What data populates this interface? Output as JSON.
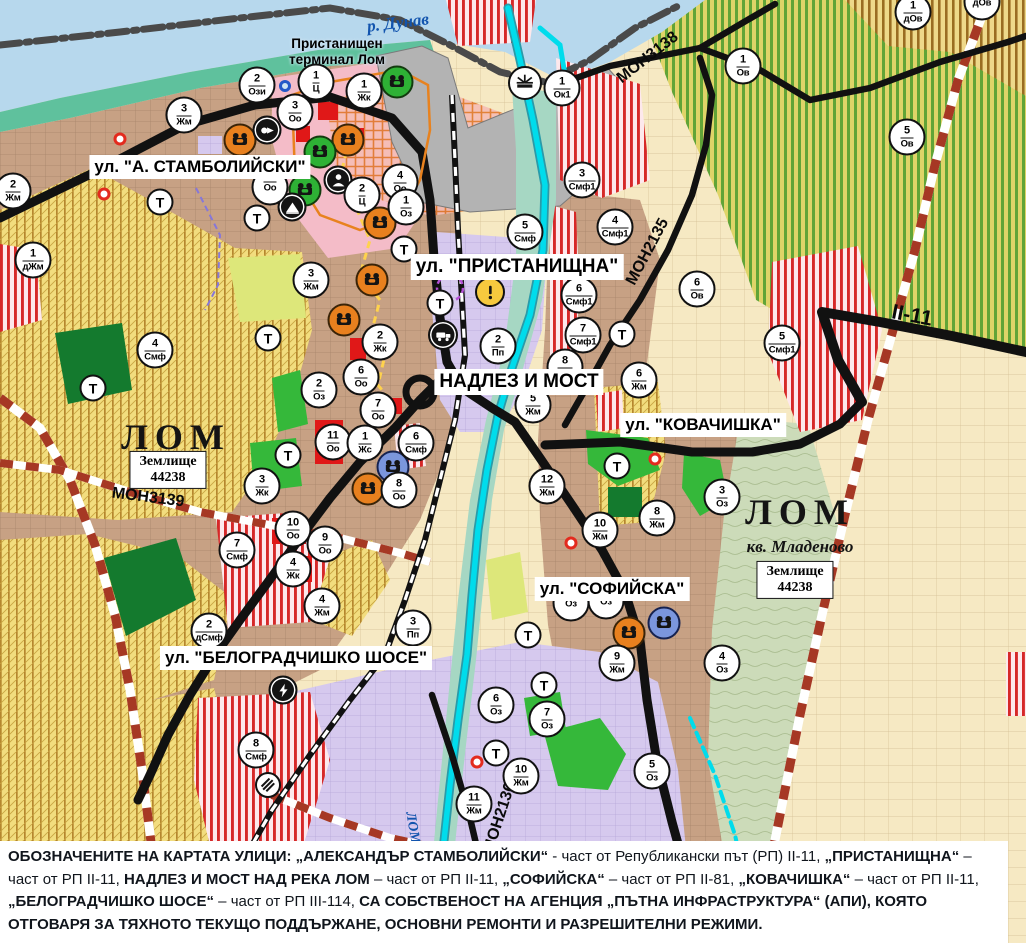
{
  "map": {
    "water_label": "р. Дунав",
    "river_label_vertical": "ЛОМ",
    "port_label": "Пристанищен\nтерминал Лом",
    "city_labels": [
      {
        "text": "ЛОМ",
        "x": 176,
        "y": 437
      },
      {
        "text": "ЛОМ",
        "x": 800,
        "y": 512
      }
    ],
    "district_label": {
      "text": "кв. Младеново",
      "x": 800,
      "y": 547
    },
    "land_plots": [
      {
        "text": "Землище\n44238",
        "x": 168,
        "y": 470
      },
      {
        "text": "Землище\n44238",
        "x": 795,
        "y": 580
      }
    ],
    "street_labels": [
      {
        "text": "ул. \"А. СТАМБОЛИЙСКИ\"",
        "x": 200,
        "y": 167,
        "size": "normal"
      },
      {
        "text": "ул. \"ПРИСТАНИЩНА\"",
        "x": 517,
        "y": 267,
        "size": "big"
      },
      {
        "text": "НАДЛЕЗ И МОСТ",
        "x": 519,
        "y": 382,
        "size": "big"
      },
      {
        "text": "ул. \"КОВАЧИШКА\"",
        "x": 703,
        "y": 425,
        "size": "normal"
      },
      {
        "text": "ул. \"СОФИЙСКА\"",
        "x": 612,
        "y": 589,
        "size": "normal"
      },
      {
        "text": "ул. \"БЕЛОГРАДЧИШКО ШОСЕ\"",
        "x": 296,
        "y": 658,
        "size": "normal"
      }
    ],
    "road_labels": [
      {
        "text": "МОН3138",
        "x": 648,
        "y": 58,
        "rotate": -38,
        "size": "normal"
      },
      {
        "text": "МОН2135",
        "x": 648,
        "y": 252,
        "rotate": -62,
        "size": "normal"
      },
      {
        "text": "II-11",
        "x": 912,
        "y": 316,
        "rotate": 11,
        "size": "big"
      },
      {
        "text": "МОН3139",
        "x": 148,
        "y": 498,
        "rotate": 7,
        "size": "normal"
      },
      {
        "text": "МОН2136",
        "x": 500,
        "y": 818,
        "rotate": -72,
        "size": "normal"
      }
    ],
    "zone_markers": [
      {
        "num": "2",
        "code": "Ози",
        "x": 257,
        "y": 85
      },
      {
        "num": "1",
        "code": "Ц",
        "x": 316,
        "y": 82
      },
      {
        "num": "1",
        "code": "Жк",
        "x": 364,
        "y": 91
      },
      {
        "num": "3",
        "code": "Оо",
        "x": 295,
        "y": 112
      },
      {
        "num": "1",
        "code": "Ок1",
        "x": 562,
        "y": 88
      },
      {
        "num": "3",
        "code": "Жм",
        "x": 184,
        "y": 115
      },
      {
        "num": "2",
        "code": "Жм",
        "x": 13,
        "y": 191
      },
      {
        "num": "1",
        "code": "дЖм",
        "x": 33,
        "y": 260
      },
      {
        "num": "4",
        "code": "Оо",
        "x": 400,
        "y": 182
      },
      {
        "num": "2",
        "code": "Ц",
        "x": 362,
        "y": 195
      },
      {
        "num": "1",
        "code": "Оз",
        "x": 406,
        "y": 207
      },
      {
        "num": "",
        "code": "Оо",
        "x": 270,
        "y": 187
      },
      {
        "num": "3",
        "code": "Жм",
        "x": 311,
        "y": 280
      },
      {
        "num": "2",
        "code": "Жк",
        "x": 380,
        "y": 342
      },
      {
        "num": "6",
        "code": "Оо",
        "x": 361,
        "y": 377
      },
      {
        "num": "7",
        "code": "Оо",
        "x": 378,
        "y": 410
      },
      {
        "num": "2",
        "code": "Оз",
        "x": 319,
        "y": 390
      },
      {
        "num": "11",
        "code": "Оо",
        "x": 333,
        "y": 442
      },
      {
        "num": "1",
        "code": "Жс",
        "x": 365,
        "y": 443
      },
      {
        "num": "6",
        "code": "Смф",
        "x": 416,
        "y": 443
      },
      {
        "num": "8",
        "code": "Оо",
        "x": 399,
        "y": 490
      },
      {
        "num": "3",
        "code": "Жк",
        "x": 262,
        "y": 486
      },
      {
        "num": "4",
        "code": "Смф",
        "x": 155,
        "y": 350
      },
      {
        "num": "10",
        "code": "Оо",
        "x": 293,
        "y": 529
      },
      {
        "num": "9",
        "code": "Оо",
        "x": 325,
        "y": 544
      },
      {
        "num": "7",
        "code": "Смф",
        "x": 237,
        "y": 550
      },
      {
        "num": "4",
        "code": "Жк",
        "x": 293,
        "y": 569
      },
      {
        "num": "4",
        "code": "Жм",
        "x": 322,
        "y": 606
      },
      {
        "num": "2",
        "code": "дСмф",
        "x": 209,
        "y": 631
      },
      {
        "num": "3",
        "code": "Пп",
        "x": 413,
        "y": 628
      },
      {
        "num": "8",
        "code": "Смф",
        "x": 256,
        "y": 750
      },
      {
        "num": "5",
        "code": "Жм",
        "x": 533,
        "y": 405
      },
      {
        "num": "8",
        "code": "Жм",
        "x": 565,
        "y": 367
      },
      {
        "num": "2",
        "code": "Пп",
        "x": 498,
        "y": 346
      },
      {
        "num": "5",
        "code": "Смф",
        "x": 525,
        "y": 232
      },
      {
        "num": "3",
        "code": "Смф1",
        "x": 582,
        "y": 180
      },
      {
        "num": "4",
        "code": "Смф1",
        "x": 615,
        "y": 227
      },
      {
        "num": "6",
        "code": "Смф1",
        "x": 579,
        "y": 295
      },
      {
        "num": "7",
        "code": "Смф1",
        "x": 583,
        "y": 335
      },
      {
        "num": "6",
        "code": "Ов",
        "x": 697,
        "y": 289
      },
      {
        "num": "6",
        "code": "Жм",
        "x": 639,
        "y": 380
      },
      {
        "num": "1",
        "code": "Ов",
        "x": 743,
        "y": 66
      },
      {
        "num": "5",
        "code": "Ов",
        "x": 907,
        "y": 137
      },
      {
        "num": "1",
        "code": "дОв",
        "x": 913,
        "y": 12
      },
      {
        "num": "",
        "code": "дОв",
        "x": 982,
        "y": 2
      },
      {
        "num": "5",
        "code": "Смф1",
        "x": 782,
        "y": 343
      },
      {
        "num": "3",
        "code": "Оз",
        "x": 722,
        "y": 497
      },
      {
        "num": "8",
        "code": "Жм",
        "x": 657,
        "y": 518
      },
      {
        "num": "10",
        "code": "Жм",
        "x": 600,
        "y": 530
      },
      {
        "num": "12",
        "code": "Жм",
        "x": 547,
        "y": 486
      },
      {
        "num": "9",
        "code": "Жм",
        "x": 617,
        "y": 663
      },
      {
        "num": "4",
        "code": "Оз",
        "x": 722,
        "y": 663
      },
      {
        "num": "6",
        "code": "Оз",
        "x": 496,
        "y": 705
      },
      {
        "num": "7",
        "code": "Оз",
        "x": 547,
        "y": 719
      },
      {
        "num": "10",
        "code": "Жм",
        "x": 521,
        "y": 776
      },
      {
        "num": "11",
        "code": "Жм",
        "x": 474,
        "y": 804
      },
      {
        "num": "5",
        "code": "Оз",
        "x": 652,
        "y": 771
      },
      {
        "num": "",
        "code": "Оз",
        "x": 571,
        "y": 603
      },
      {
        "num": "",
        "code": "Оз",
        "x": 606,
        "y": 601
      }
    ],
    "transport_markers": [
      {
        "label": "Т",
        "x": 160,
        "y": 202
      },
      {
        "label": "Т",
        "x": 257,
        "y": 218
      },
      {
        "label": "Т",
        "x": 268,
        "y": 338
      },
      {
        "label": "Т",
        "x": 93,
        "y": 388
      },
      {
        "label": "Т",
        "x": 288,
        "y": 455
      },
      {
        "label": "Т",
        "x": 404,
        "y": 249
      },
      {
        "label": "Т",
        "x": 440,
        "y": 303
      },
      {
        "label": "Т",
        "x": 622,
        "y": 334
      },
      {
        "label": "Т",
        "x": 617,
        "y": 466
      },
      {
        "label": "Т",
        "x": 528,
        "y": 635
      },
      {
        "label": "Т",
        "x": 544,
        "y": 685
      },
      {
        "label": "Т",
        "x": 496,
        "y": 753
      }
    ],
    "icon_markers": [
      {
        "type": "culture",
        "color": "orange",
        "x": 240,
        "y": 140
      },
      {
        "type": "culture",
        "color": "orange",
        "x": 348,
        "y": 140
      },
      {
        "type": "culture",
        "color": "orange",
        "x": 380,
        "y": 223
      },
      {
        "type": "culture",
        "color": "orange",
        "x": 372,
        "y": 280
      },
      {
        "type": "culture",
        "color": "orange",
        "x": 344,
        "y": 320
      },
      {
        "type": "culture",
        "color": "orange",
        "x": 368,
        "y": 489
      },
      {
        "type": "culture",
        "color": "orange",
        "x": 629,
        "y": 633
      },
      {
        "type": "culture",
        "color": "green",
        "x": 397,
        "y": 82
      },
      {
        "type": "culture",
        "color": "green",
        "x": 320,
        "y": 152
      },
      {
        "type": "culture",
        "color": "green",
        "x": 305,
        "y": 190
      },
      {
        "type": "culture",
        "color": "blue",
        "x": 393,
        "y": 467
      },
      {
        "type": "culture",
        "color": "blue",
        "x": 664,
        "y": 623
      },
      {
        "type": "person",
        "color": "black",
        "x": 338,
        "y": 180
      },
      {
        "type": "tunnel",
        "color": "black",
        "x": 292,
        "y": 207
      },
      {
        "type": "arrow",
        "color": "black",
        "x": 267,
        "y": 130
      },
      {
        "type": "truck",
        "color": "black",
        "x": 443,
        "y": 335
      },
      {
        "type": "power",
        "color": "black",
        "x": 283,
        "y": 690
      },
      {
        "type": "station",
        "color": "white",
        "x": 268,
        "y": 785
      },
      {
        "type": "portcrane",
        "color": "white",
        "x": 525,
        "y": 83
      },
      {
        "type": "warning",
        "color": "warn",
        "x": 490,
        "y": 292
      }
    ],
    "small_dots_red": [
      {
        "x": 120,
        "y": 139
      },
      {
        "x": 104,
        "y": 194
      },
      {
        "x": 655,
        "y": 459
      },
      {
        "x": 571,
        "y": 543
      },
      {
        "x": 477,
        "y": 762
      }
    ],
    "small_rings_blue": [
      {
        "x": 285,
        "y": 86
      }
    ],
    "note_segments": [
      {
        "bold": true,
        "text": "ОБОЗНАЧЕНИТЕ НА КАРТАТА УЛИЦИ: „АЛЕКСАНДЪР СТАМБОЛИЙСКИ“"
      },
      {
        "bold": false,
        "text": " - част от Републикански път (РП) II-11, "
      },
      {
        "bold": true,
        "text": "„ПРИСТАНИЩНА“"
      },
      {
        "bold": false,
        "text": " – част от РП II-11, "
      },
      {
        "bold": true,
        "text": "НАДЛЕЗ И МОСТ НАД РЕКА ЛОМ"
      },
      {
        "bold": false,
        "text": " – част от РП II-11, "
      },
      {
        "bold": true,
        "text": "„СОФИЙСКА“"
      },
      {
        "bold": false,
        "text": " – част от РП II-81, "
      },
      {
        "bold": true,
        "text": "„КОВАЧИШКА“"
      },
      {
        "bold": false,
        "text": " – част от РП II-11, "
      },
      {
        "bold": true,
        "text": "„БЕЛОГРАДЧИШКО ШОСЕ“"
      },
      {
        "bold": false,
        "text": " – част от РП III-114, "
      },
      {
        "bold": true,
        "text": "СА СОБСТВЕНОСТ НА АГЕНЦИЯ „ПЪТНА ИНФРАСТРУКТУРА“ (АПИ), КОЯТО ОТГОВАРЯ ЗА ТЯХНОТО ТЕКУЩО ПОДДЪРЖАНЕ, ОСНОВНИ РЕМОНТИ И РАЗРЕШИТЕЛНИ РЕЖИМИ."
      }
    ],
    "colors": {
      "water": "#b7d8ed",
      "river_line": "#00dcec",
      "main_road": "#111111",
      "municipal_road_dash": "#a63824",
      "residential_tan": "#c7a184",
      "industrial_lavender": "#d6c9ee",
      "orchard_yellow": "#dfd468",
      "orchard_green_stripe": "#61a437",
      "mixed_use_red": "#d62828",
      "green_area": "#35b83a",
      "port_gray": "#b3b3b3",
      "note_background": "#ffffff"
    }
  }
}
